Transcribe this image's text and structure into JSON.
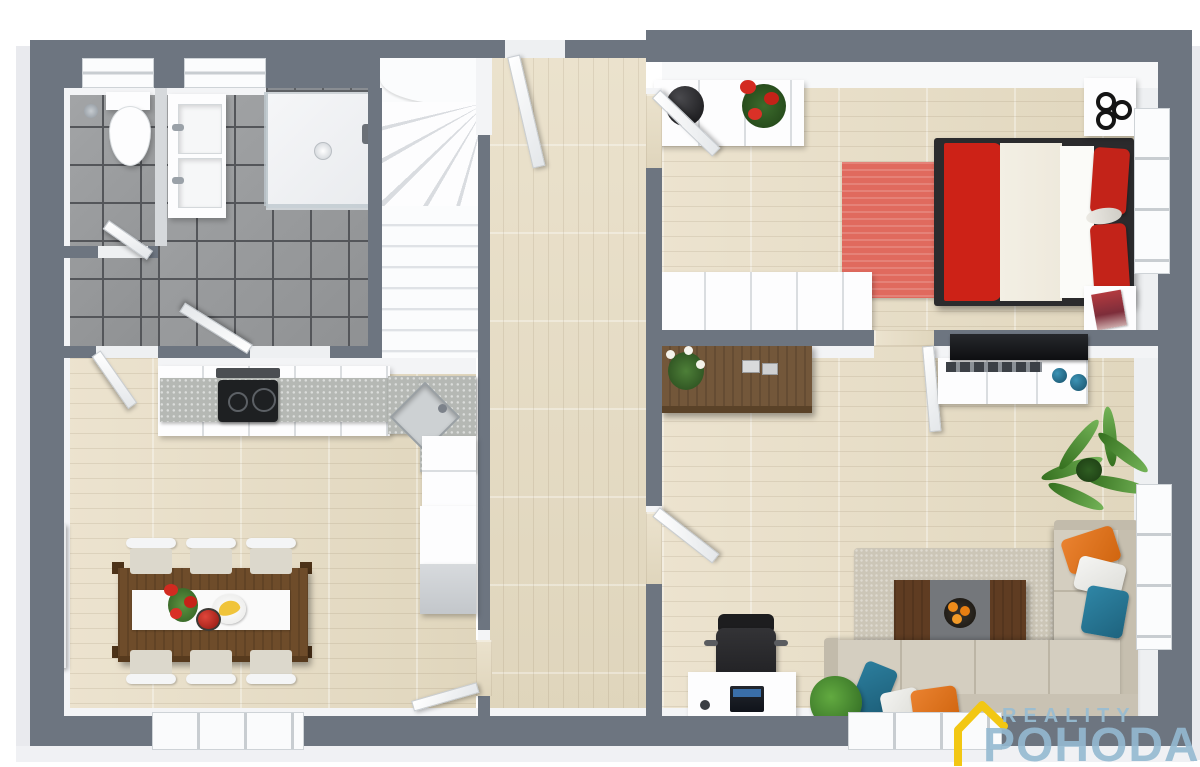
{
  "branding": {
    "line1": "REALITY",
    "line2": "POHODA",
    "icon": "house-outline-icon",
    "icon_color": "#f2c713",
    "text_color": "#98bdd2"
  },
  "scene": {
    "type": "3d-floor-plan-top-view",
    "rooms": [
      {
        "name": "wc",
        "floor": "gray-tile",
        "items": [
          "toilet",
          "window",
          "door",
          "waste-bin"
        ]
      },
      {
        "name": "bathroom",
        "floor": "gray-tile",
        "items": [
          "double-sink-vanity",
          "shower-enclosure",
          "window",
          "door"
        ]
      },
      {
        "name": "staircase",
        "floor": "white",
        "items": [
          "winder-stairs"
        ]
      },
      {
        "name": "hallway",
        "floor": "light-wood",
        "items": [
          "entry-door"
        ]
      },
      {
        "name": "bedroom",
        "floor": "light-wood",
        "items": [
          "double-bed-red-white",
          "red-rug",
          "nightstand-top",
          "nightstand-bottom",
          "sideboard-with-vase-and-red-flowers",
          "long-dresser",
          "window",
          "door",
          "magazine"
        ]
      },
      {
        "name": "kitchen-dining",
        "floor": "light-wood",
        "items": [
          "l-shaped-counter",
          "cooktop",
          "corner-sink",
          "tall-cabinet",
          "dining-table",
          "table-runner",
          "red-flowers",
          "banana-plate",
          "apple-bowl",
          "six-white-chairs",
          "wall-art",
          "window",
          "door"
        ]
      },
      {
        "name": "living-room",
        "floor": "light-wood",
        "items": [
          "corner-sofa-beige",
          "orange-pillows",
          "teal-pillows",
          "white-pillows",
          "coffee-table",
          "orange-fruit-bowl",
          "area-rug",
          "tv-unit",
          "tv",
          "wood-sideboard-with-orchid",
          "desk",
          "office-chair",
          "laptop",
          "palm-plant",
          "shrub-plant",
          "window",
          "door"
        ]
      }
    ],
    "palette": {
      "wall": "#6d7580",
      "wall_face": "#f3f4f6",
      "wood_floor": "#e7ddc6",
      "tile_floor": "#97999b",
      "stairs": "#fafbfc",
      "accent_red": "#cd2217",
      "rug_red": "#e06a5e",
      "sofa_beige": "#d4cec0",
      "pillow_orange": "#e0731e",
      "pillow_teal": "#27799a",
      "furniture_wood": "#6e4c2a",
      "granite": "#b5b8b4"
    }
  }
}
